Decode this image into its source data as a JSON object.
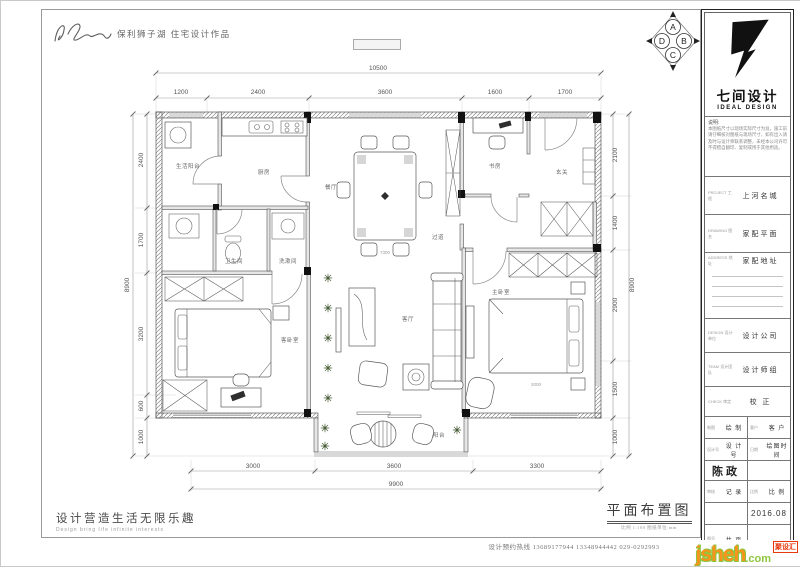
{
  "header": {
    "signature": "陈政",
    "project_title": "保利狮子湖 住宅设计作品",
    "compass": {
      "top": "A",
      "right": "B",
      "bottom": "C",
      "left": "D"
    }
  },
  "plan": {
    "rooms": {
      "service_balcony": "生活阳台",
      "kitchen": "厨房",
      "dining": "餐厅",
      "study": "书房",
      "entry": "玄关",
      "bath": "卫生间",
      "wash": "洗漱间",
      "hallway": "过道",
      "guest_bedroom": "客卧室",
      "living": "客厅",
      "master_bedroom": "主卧室",
      "balcony": "阳台"
    },
    "dims": {
      "top": {
        "overall": "10500",
        "segments": [
          "1200",
          "2400",
          "3600",
          "1600",
          "1700"
        ]
      },
      "left": {
        "overall": "8900",
        "segments": [
          "2400",
          "1700",
          "3200",
          "600",
          "1000"
        ]
      },
      "right": {
        "overall": "8900",
        "segments": [
          "2100",
          "1400",
          "2900",
          "1500",
          "1000"
        ]
      },
      "bottom": {
        "overall": "9900",
        "segments": [
          "3000",
          "3600",
          "3300"
        ]
      }
    },
    "inner_dims": {
      "dining_width": "7300",
      "master_bed": "2000"
    }
  },
  "titleblock": {
    "logo_cn": "七间设计",
    "logo_en": "IDEAL DESIGN",
    "note_label": "说明:",
    "note_lines": [
      "本图纸尺寸以现场实际尺寸为准，施工前",
      "请仔细核对图纸与现场尺寸，如有出入请",
      "及时与设计师联系调整，未经本公司许可",
      "不得擅自翻印、复制或用于其他用途。"
    ],
    "rows": [
      {
        "label": "PROJECT 工程",
        "value": "上河名城"
      },
      {
        "label": "DRAWING 图名",
        "value": "家配平面"
      },
      {
        "label": "ADDRESS 地址",
        "value": "家配地址"
      },
      {
        "label": "DESIGN 设计单位",
        "value": "设计公司"
      },
      {
        "label": "TEAM 设计团队",
        "value": "设计师组"
      },
      {
        "label": "CHECK 审定",
        "value": "校 正"
      }
    ],
    "grid": {
      "g1l": "制图",
      "g1v": "绘 制",
      "g1r": "客户",
      "g1rv": "客 户",
      "g2l": "设计号",
      "g2v": "设 计 号",
      "g2r": "日期",
      "g2rv": "绘图时间",
      "stamp": "陈政",
      "g4l": "审核",
      "g4v": "记 录",
      "g4r": "比例",
      "g4rv": "比 例",
      "date": "2016.08",
      "g6l": "图号",
      "g6v": "共  页"
    }
  },
  "footer": {
    "slogan_cn": "设计营造生活无限乐趣",
    "slogan_en": "Design bring life infinite interests",
    "drawing_title": "平面布置图",
    "drawing_note": "比例 1:100  图纸单位:mm",
    "contact": "设计预约热线 13689177944 13348944442 029-0292993"
  },
  "watermark": {
    "site": "jsheh",
    "tld": ".com",
    "badge": "聚设汇"
  }
}
